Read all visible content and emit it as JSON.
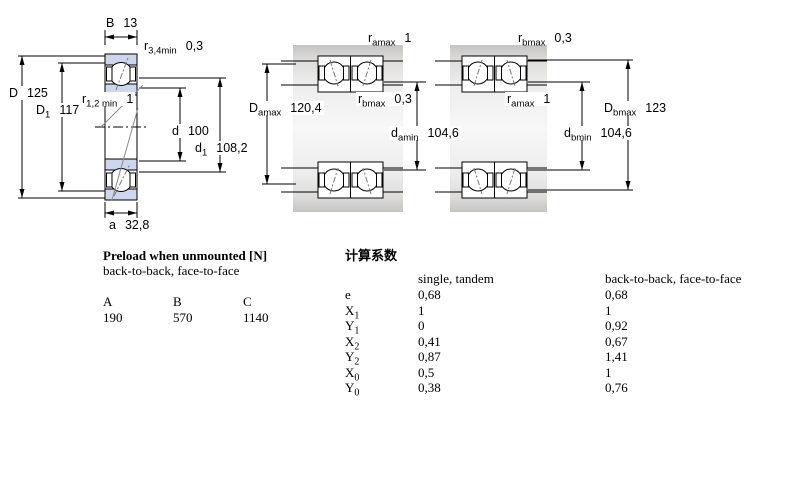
{
  "colors": {
    "bearing_fill": "#ccd7ee",
    "housing_gray": "#d9d9d9",
    "line": "#000000",
    "background": "#ffffff"
  },
  "left_drawing": {
    "B": {
      "sym": "B",
      "sub": "",
      "value": "13"
    },
    "r34": {
      "sym": "r",
      "sub": "3,4min",
      "value": "0,3"
    },
    "D": {
      "sym": "D",
      "sub": "",
      "value": "125"
    },
    "r12": {
      "sym": "r",
      "sub": "1,2 min",
      "value": "1"
    },
    "D1": {
      "sym": "D",
      "sub": "1",
      "value": "117"
    },
    "d": {
      "sym": "d",
      "sub": "",
      "value": "100"
    },
    "d1": {
      "sym": "d",
      "sub": "1",
      "value": "108,2"
    },
    "a": {
      "sym": "a",
      "sub": "",
      "value": "32,8"
    }
  },
  "middle_drawing": {
    "ramax": {
      "sym": "r",
      "sub": "amax",
      "value": "1"
    },
    "rbmax": {
      "sym": "r",
      "sub": "bmax",
      "value": "0,3"
    },
    "Damax": {
      "sym": "D",
      "sub": "amax",
      "value": "120,4"
    },
    "damin": {
      "sym": "d",
      "sub": "amin",
      "value": "104,6"
    }
  },
  "right_drawing": {
    "rbmax": {
      "sym": "r",
      "sub": "bmax",
      "value": "0,3"
    },
    "ramax": {
      "sym": "r",
      "sub": "amax",
      "value": "1"
    },
    "Dbmax": {
      "sym": "D",
      "sub": "bmax",
      "value": "123"
    },
    "dbmin": {
      "sym": "d",
      "sub": "bmin",
      "value": "104,6"
    }
  },
  "preload": {
    "title": "Preload when unmounted [N]",
    "subtitle": "back-to-back, face-to-face",
    "columns": [
      "A",
      "B",
      "C"
    ],
    "values": [
      "190",
      "570",
      "1140"
    ]
  },
  "factors": {
    "title": "计算系数",
    "col1_header": "single, tandem",
    "col2_header": "back-to-back, face-to-face",
    "rows": [
      {
        "s": "e",
        "sub": "",
        "v1": "0,68",
        "v2": "0,68"
      },
      {
        "s": "X",
        "sub": "1",
        "v1": "1",
        "v2": "1"
      },
      {
        "s": "Y",
        "sub": "1",
        "v1": "0",
        "v2": "0,92"
      },
      {
        "s": "X",
        "sub": "2",
        "v1": "0,41",
        "v2": "0,67"
      },
      {
        "s": "Y",
        "sub": "2",
        "v1": "0,87",
        "v2": "1,41"
      },
      {
        "s": "X",
        "sub": "0",
        "v1": "0,5",
        "v2": "1"
      },
      {
        "s": "Y",
        "sub": "0",
        "v1": "0,38",
        "v2": "0,76"
      }
    ]
  }
}
